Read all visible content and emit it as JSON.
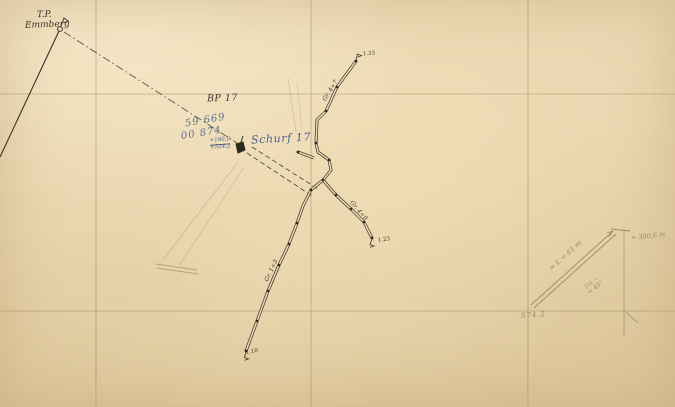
{
  "map": {
    "title": "Schurf 17 survey sheet (scanned field map)",
    "colors": {
      "paper": "#e9d5ae",
      "grid": "#8f7a50",
      "ink": "#3a342b",
      "blue_annotation": "#4a5d8c",
      "pencil": "#8b7a5f"
    },
    "triangulation_point": {
      "abbr": "T.P.",
      "name": "Emmberg"
    },
    "bp_label": "BP 17",
    "schurf": {
      "label": "Schurf 17",
      "coord_line_1": "59 669",
      "coord_line_2": "00 874",
      "elev_top": "+180,0",
      "elev_bottom": "+524,2"
    },
    "trenches": [
      {
        "label": "Gr. 4÷7",
        "endpoint_label": "1.33"
      },
      {
        "label": "Gr. 4÷9",
        "endpoint_label": "1.23"
      },
      {
        "label": "Gr. 1÷3",
        "endpoint_label": "1.10"
      }
    ],
    "pencil_notes": {
      "length_note": "≈ L = 61 m",
      "distance_note": "≈ 380,6 m",
      "angle_note_top": "1½ ~",
      "angle_note_bottom": "≈ 45°",
      "corner_value": "574.2"
    }
  }
}
